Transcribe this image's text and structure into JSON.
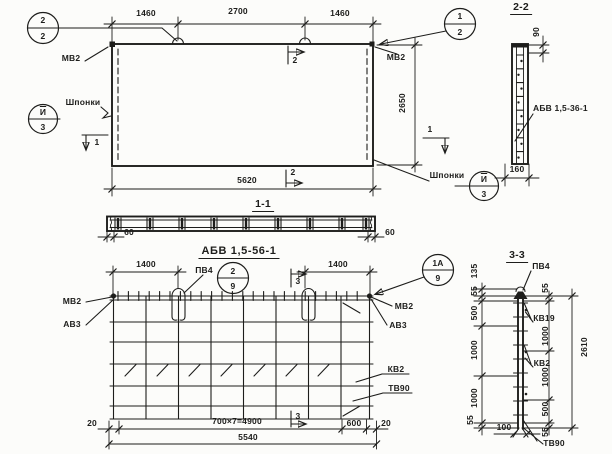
{
  "top_view": {
    "dim_1460_left": "1460",
    "dim_2700": "2700",
    "dim_1460_right": "1460",
    "dim_5620": "5620",
    "dim_2650": "2650",
    "mv2_left": "МВ2",
    "mv2_right": "МВ2",
    "keys_left": "Шпонки",
    "keys_bottom": "Шпонки",
    "callout_loop": {
      "num": "2",
      "den": "2"
    },
    "callout_corner": {
      "num": "1",
      "den": "2"
    },
    "callout_keys_left": {
      "num": "И",
      "den": "3"
    },
    "callout_keys_bottom": {
      "num": "И",
      "den": "3"
    },
    "mark_1_left": "1",
    "mark_1_right": "1",
    "mark_2_top": "2",
    "mark_2_bottom": "2",
    "section_title": "1-1"
  },
  "section_1_1": {
    "dim_60_left": "60",
    "dim_60_right": "60",
    "caption": "АБВ 1,5-56-1"
  },
  "reinforcement_view": {
    "dim_1400_left": "1400",
    "dim_1400_right": "1400",
    "pv4": "ПВ4",
    "callout_pv4": {
      "num": "2",
      "den": "9"
    },
    "callout_corner": {
      "num": "1А",
      "den": "9"
    },
    "mark_3_top": "3",
    "mark_3_bottom": "3",
    "mv2_left": "МВ2",
    "av3_left": "АВ3",
    "mv2_right": "МВ2",
    "av3_right": "АВ3",
    "kv2": "КВ2",
    "tv90": "ТВ90",
    "dim_20_left": "20",
    "dim_4900": "700×7=4900",
    "dim_600": "600",
    "dim_20_right": "20",
    "dim_5540": "5540"
  },
  "section_2_2": {
    "title": "2-2",
    "dim_90": "90",
    "dim_160": "160",
    "bar_label": "АБВ 1,5-36-1"
  },
  "section_3_3": {
    "title": "3-3",
    "dims_left": {
      "d135": "135",
      "d55_top": "55",
      "d500": "500",
      "d1000_a": "1000",
      "d1000_b": "1000",
      "d55_bottom": "55"
    },
    "dim_100": "100",
    "dims_right": {
      "d55_top": "55",
      "d1000_a": "1000",
      "d1000_b": "1000",
      "d500": "500",
      "d55_bottom": "55"
    },
    "dim_2610": "2610",
    "pv4": "ПВ4",
    "kv19": "КВ19",
    "kv2": "КВ2",
    "tv90": "ТВ90"
  }
}
